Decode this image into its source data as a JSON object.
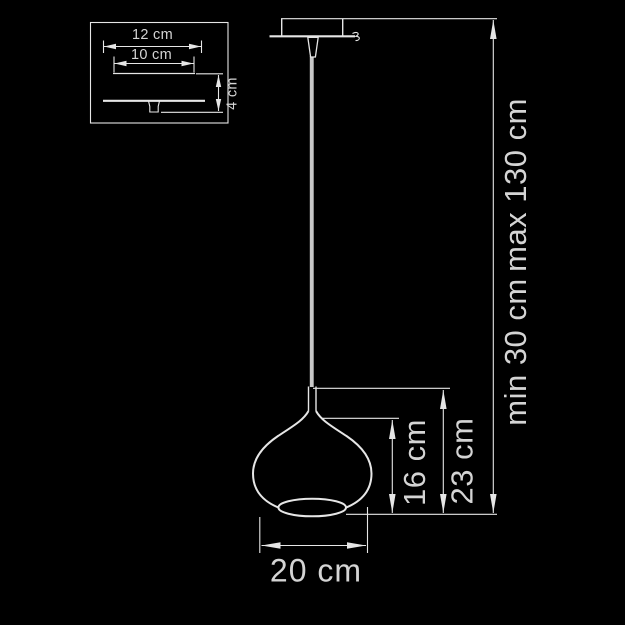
{
  "colors": {
    "background": "#000000",
    "line": "#e6e6e6",
    "text": "#d4d4d4",
    "cord": "#c8c8c8"
  },
  "mount_inset": {
    "outer_width_label": "12 cm",
    "inner_width_label": "10 cm",
    "height_label": "4 cm"
  },
  "pendant": {
    "shade_diameter_label": "20 cm",
    "shade_height_label": "16 cm",
    "shade_total_height_label": "23 cm",
    "suspension_min_label": "min 30 cm",
    "suspension_max_label": "max 130 cm"
  }
}
